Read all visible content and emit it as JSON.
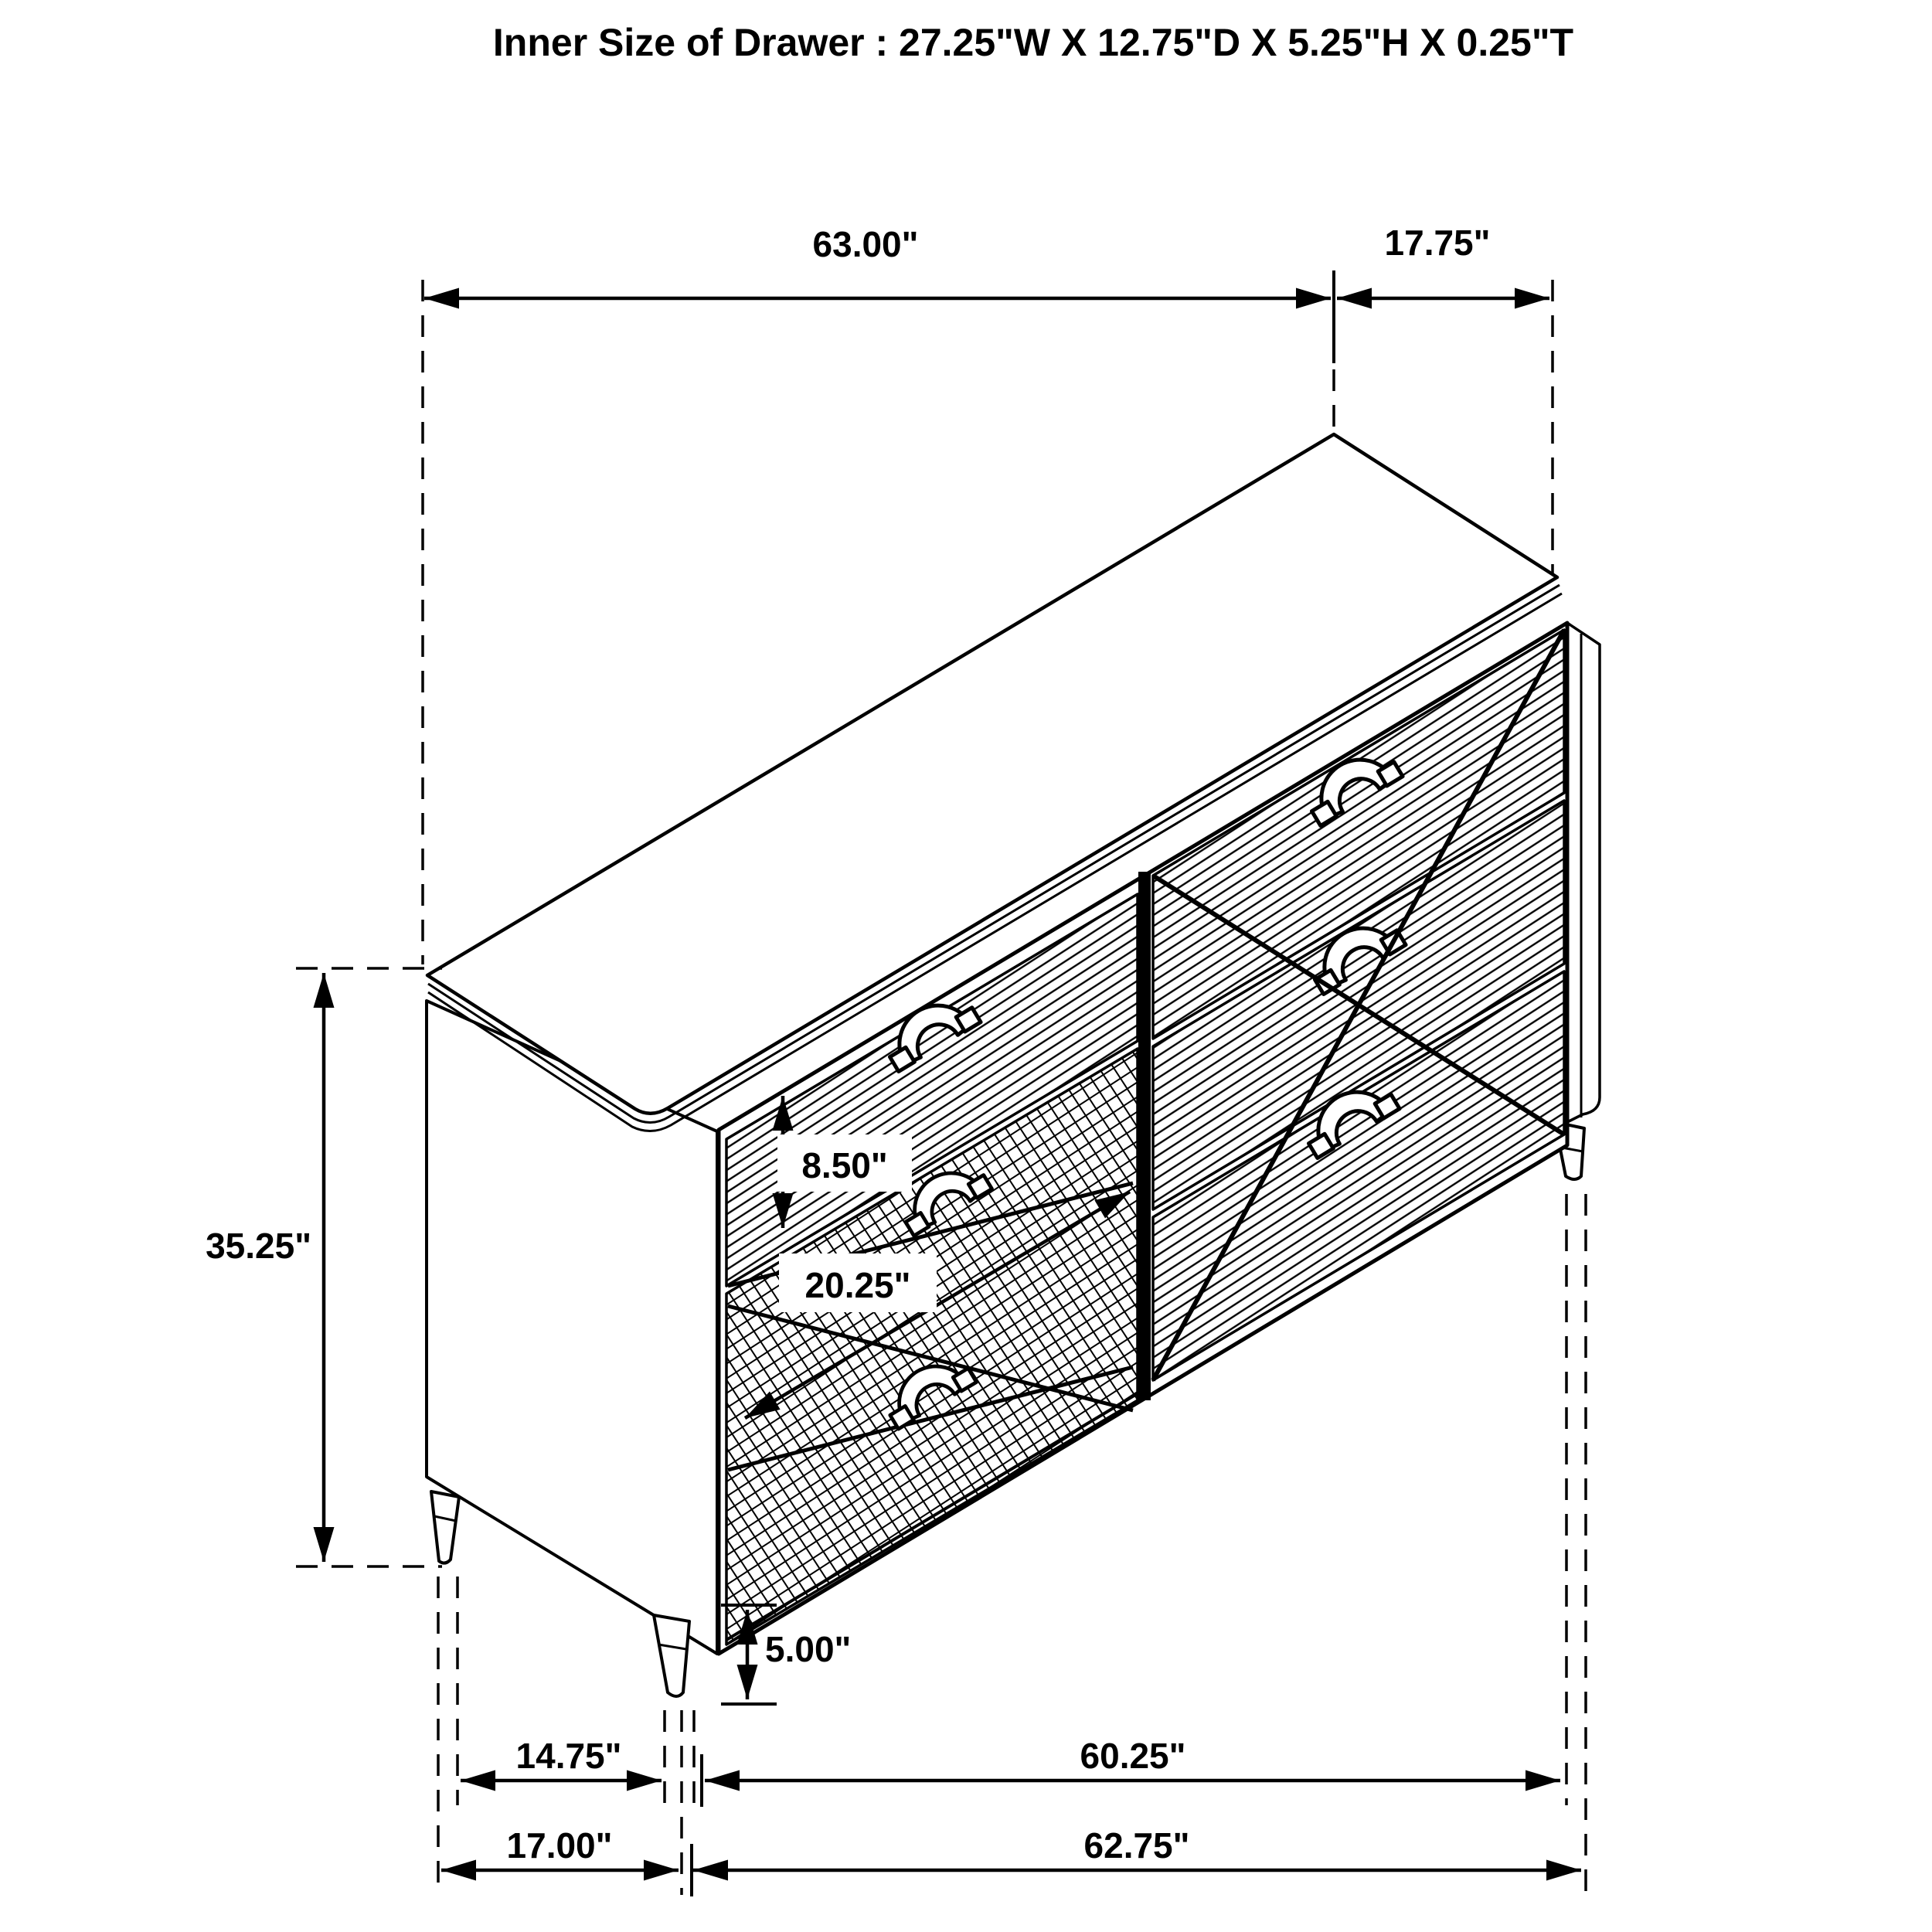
{
  "title": "Inner Size of Drawer : 27.25\"W X 12.75\"D X 5.25\"H X 0.25\"T",
  "dims": {
    "width_top": "63.00\"",
    "depth_top": "17.75\"",
    "height_overall": "35.25\"",
    "drawer_front_height": "8.50\"",
    "drawer_inner_depth": "20.25\"",
    "leg_height": "5.00\"",
    "foot_inset_depth": "14.75\"",
    "foot_span_width": "60.25\"",
    "base_depth_total": "17.00\"",
    "base_width_total": "62.75\""
  },
  "colors": {
    "line": "#000000",
    "background": "#ffffff"
  }
}
